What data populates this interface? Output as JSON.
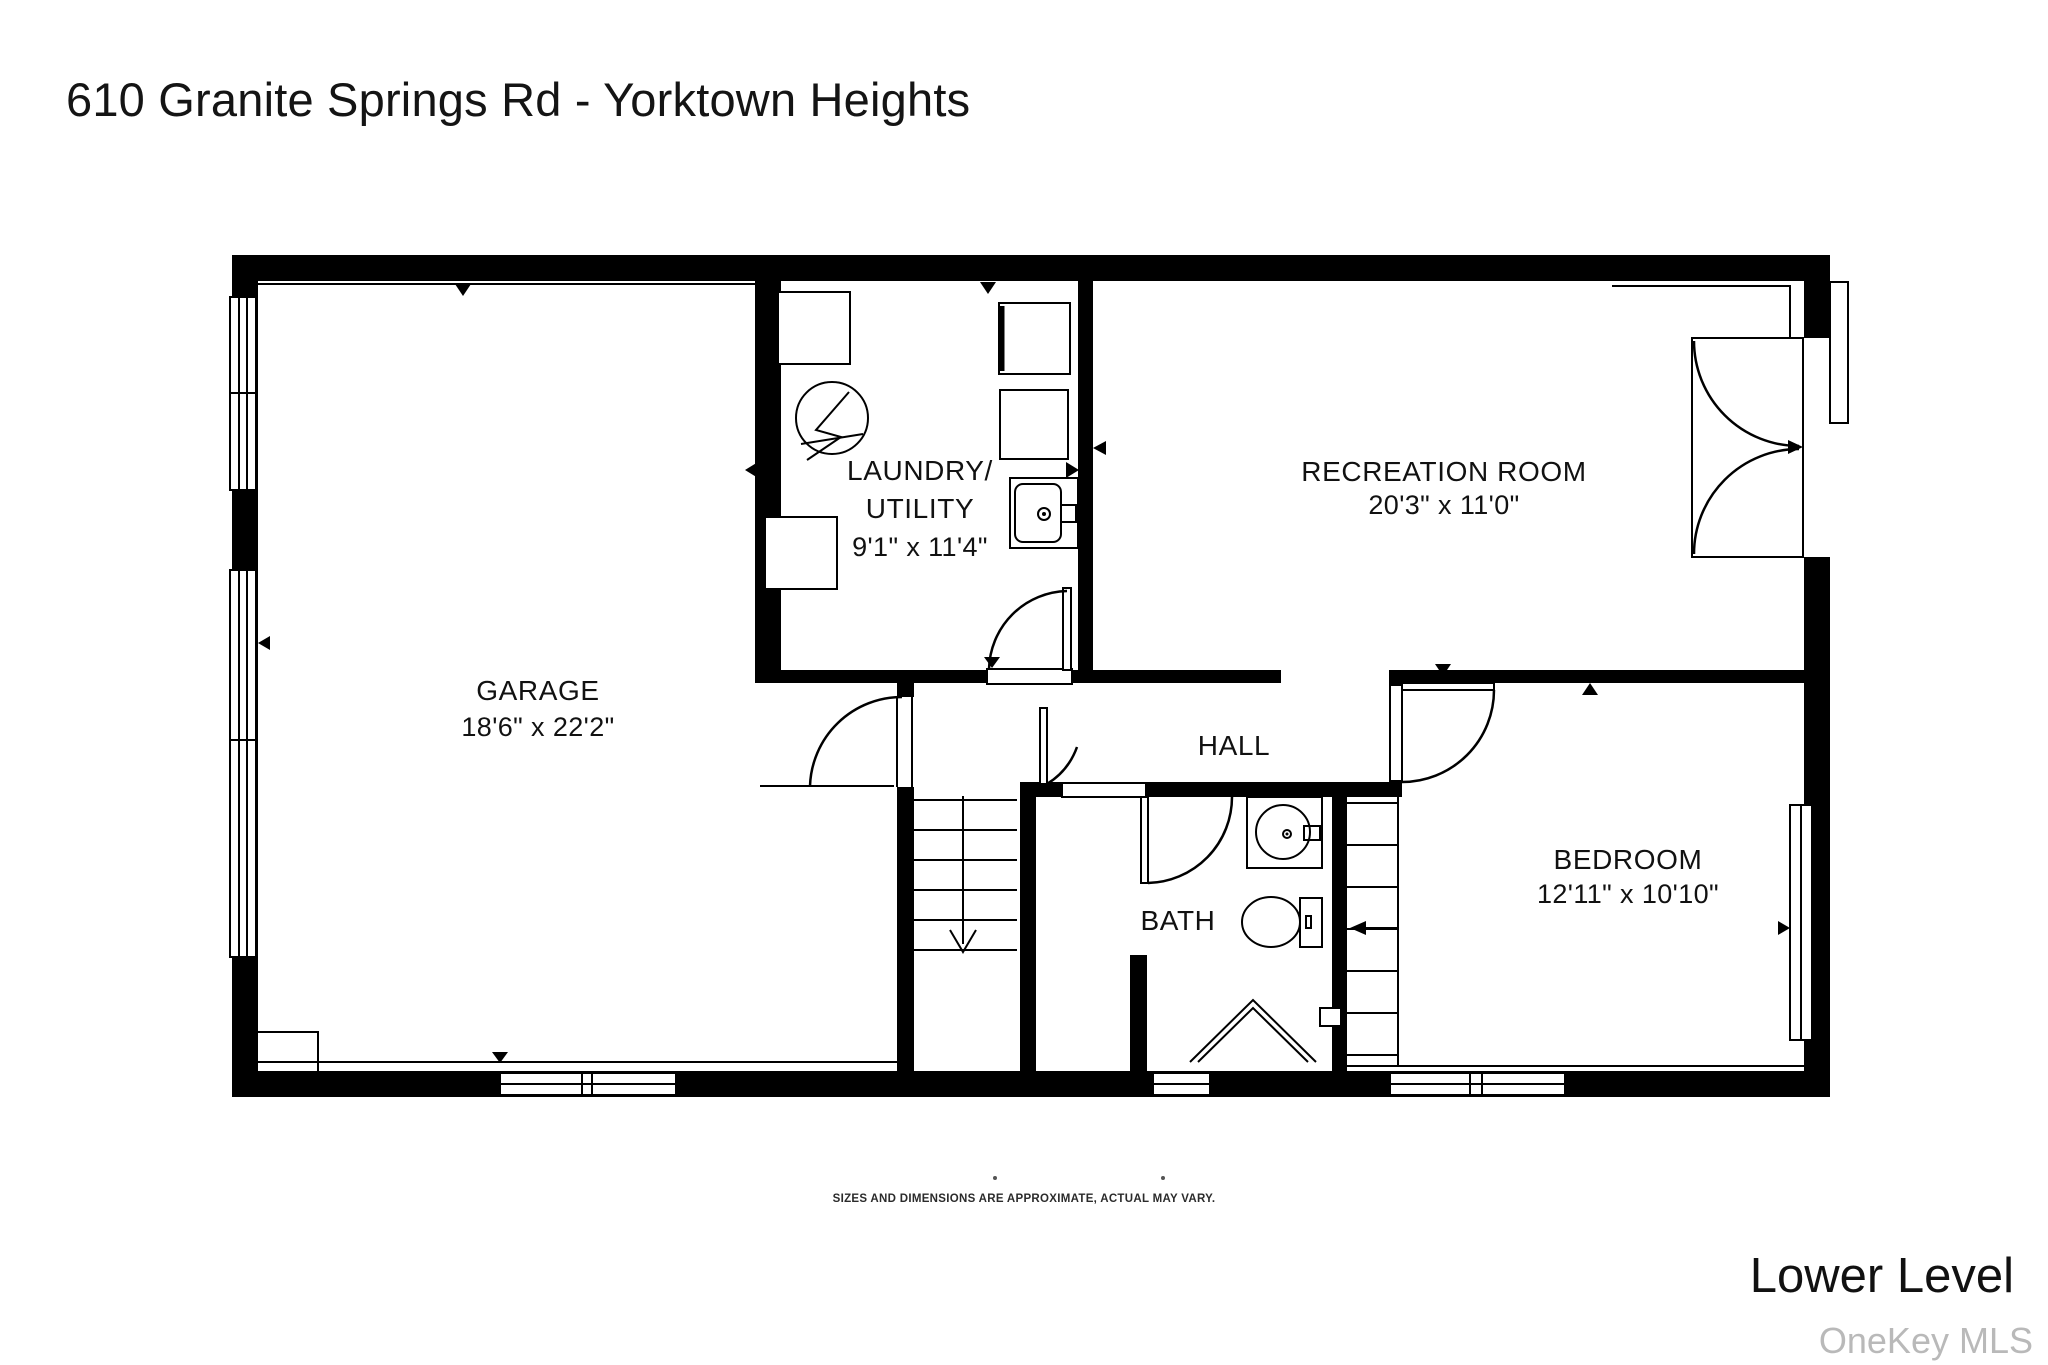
{
  "title": "610 Granite Springs Rd - Yorktown Heights",
  "floor_label": "Lower Level",
  "watermark": "OneKey MLS",
  "disclaimer": "SIZES AND DIMENSIONS ARE APPROXIMATE, ACTUAL MAY VARY.",
  "rooms": {
    "garage": {
      "name": "GARAGE",
      "dims": "18'6\" x 22'2\""
    },
    "laundry": {
      "name_line1": "LAUNDRY/",
      "name_line2": "UTILITY",
      "dims": "9'1\" x 11'4\""
    },
    "recreation": {
      "name": "RECREATION ROOM",
      "dims": "20'3\" x 11'0\""
    },
    "hall": {
      "name": "HALL"
    },
    "bath": {
      "name": "BATH"
    },
    "bedroom": {
      "name": "BEDROOM",
      "dims": "12'11\" x 10'10\""
    }
  },
  "colors": {
    "wall": "#000000",
    "background": "#ffffff",
    "watermark_text": "#b9b9b9"
  }
}
